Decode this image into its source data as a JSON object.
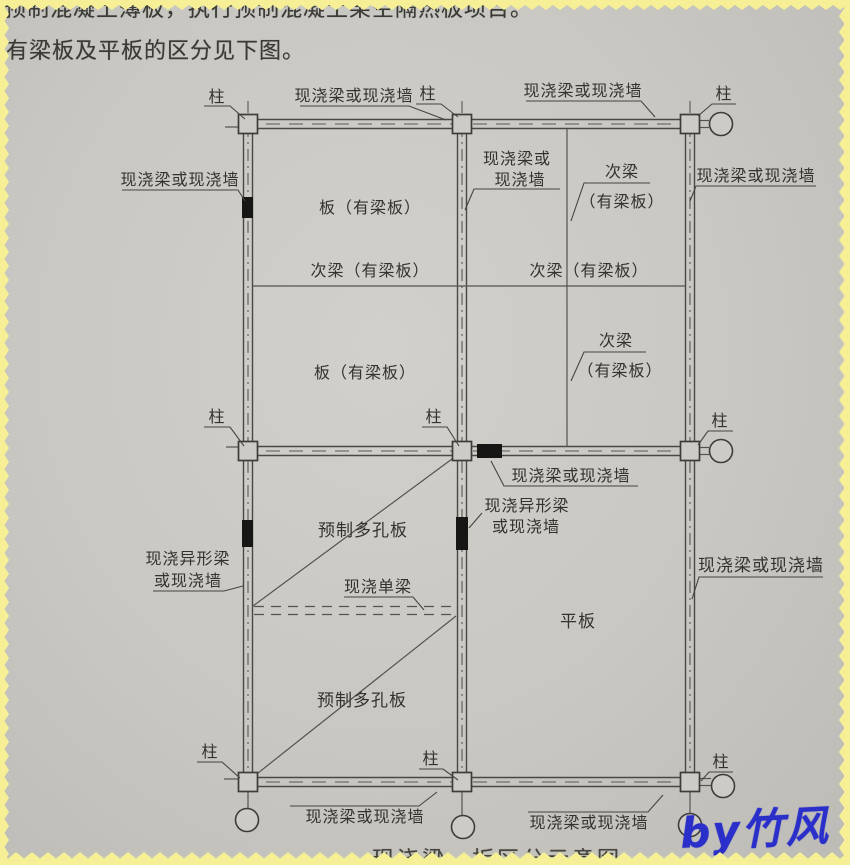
{
  "page": {
    "text_line1": "预制混凝土薄板，执行预制混凝土架空隔热板项目。",
    "text_line2": "有梁板及平板的区分见下图。",
    "caption": "现浇梁、板区分示意图",
    "watermark": "by竹风"
  },
  "diagram": {
    "labels": {
      "column": "柱",
      "cast_beam_or_wall": "现浇梁或现浇墙",
      "cast_beam_or": "现浇梁或",
      "cast_wall": "现浇墙",
      "secondary_beam_with_slab": "次梁（有梁板）",
      "secondary_beam": "次梁",
      "with_beam_slab_paren": "（有梁板）",
      "slab_with_beam": "板（有梁板）",
      "cast_shaped_beam": "现浇异形梁",
      "or_cast_wall": "或现浇墙",
      "precast_hollow_slab": "预制多孔板",
      "cast_single_beam": "现浇单梁",
      "flat_slab": "平板"
    },
    "colors": {
      "paper": "#cac8c3",
      "ink": "#3a3934",
      "line": "#4c4a45",
      "edge_yellow": "#f7ef96",
      "watermark_blue": "#2b2fc9"
    }
  }
}
